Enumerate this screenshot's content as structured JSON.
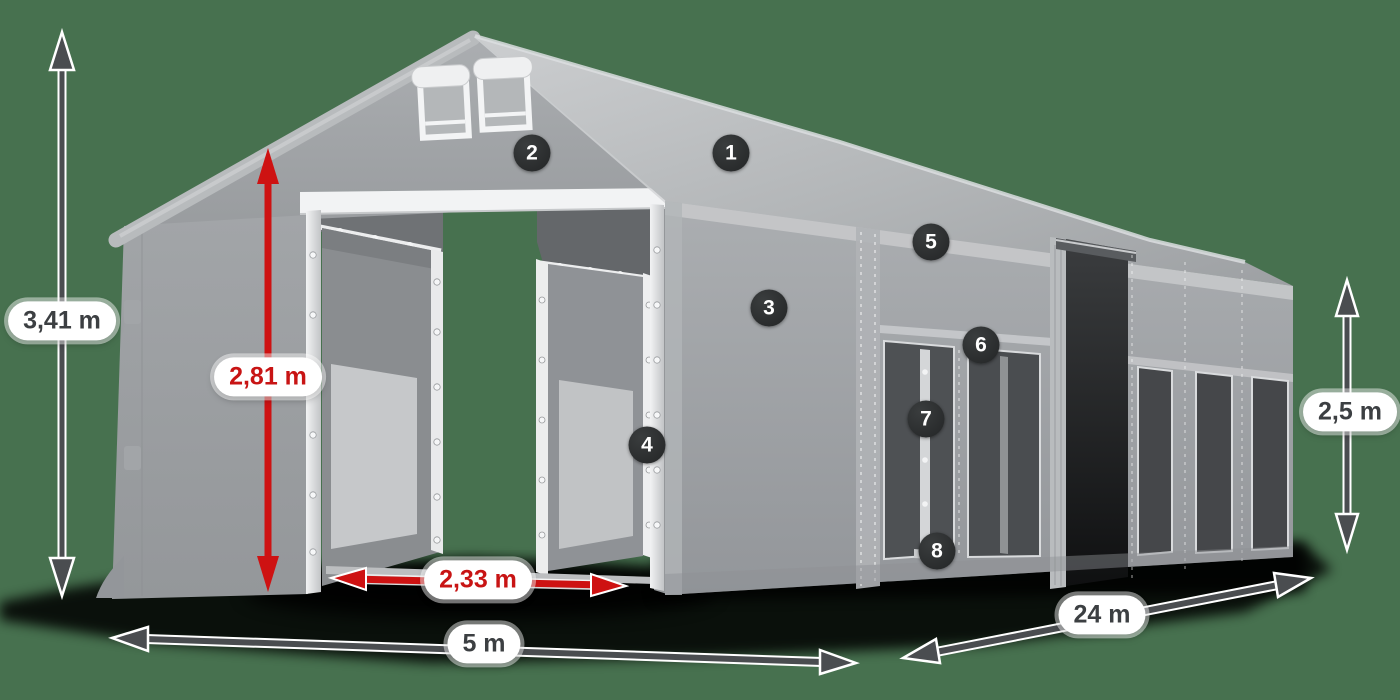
{
  "canvas": {
    "background_color": "#47714F"
  },
  "dimensions": {
    "total_height": "3,41 m",
    "door_height": "2,81 m",
    "door_width": "2,33 m",
    "front_width": "5 m",
    "side_length": "24 m",
    "side_height": "2,5 m"
  },
  "markers": [
    "1",
    "2",
    "3",
    "4",
    "5",
    "6",
    "7",
    "8"
  ],
  "colors": {
    "background_green": "#47714F",
    "dimension_arrow_gray": "#4A4D50",
    "dimension_arrow_red": "#CE1212",
    "label_pill_background": "#FFFFFF",
    "label_text_dark": "#3C3F42",
    "label_text_red": "#C81414",
    "marker_badge_background": "#2B2D2E",
    "marker_badge_text": "#FFFFFF",
    "tent_fabric_gray": "#A2A5A8"
  }
}
